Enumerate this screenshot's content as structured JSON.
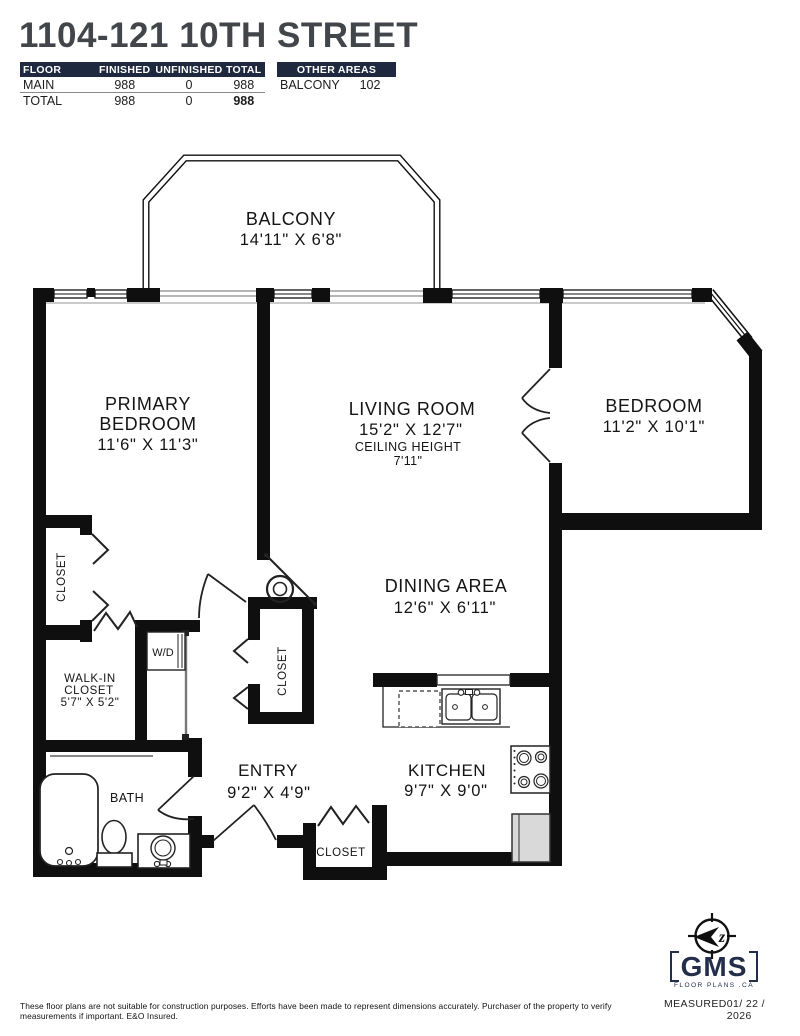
{
  "header": {
    "title": "1104-121 10TH STREET",
    "floor_table": {
      "headers": [
        "FLOOR",
        "FINISHED",
        "UNFINISHED",
        "TOTAL"
      ],
      "rows": [
        {
          "floor": "MAIN",
          "finished": "988",
          "unfinished": "0",
          "total": "988"
        },
        {
          "floor": "TOTAL",
          "finished": "988",
          "unfinished": "0",
          "total": "988"
        }
      ]
    },
    "other_areas_table": {
      "header": "OTHER AREAS",
      "rows": [
        {
          "area": "BALCONY",
          "value": "102"
        }
      ]
    }
  },
  "plan": {
    "balcony": {
      "name": "BALCONY",
      "dims": "14'11\" X 6'8\""
    },
    "primary_bedroom": {
      "line1": "PRIMARY",
      "line2": "BEDROOM",
      "dims": "11'6\" X 11'3\""
    },
    "living_room": {
      "name": "LIVING ROOM",
      "dims": "15'2\" X 12'7\"",
      "ceiling_label": "CEILING HEIGHT",
      "ceiling_value": "7'11\""
    },
    "bedroom": {
      "name": "BEDROOM",
      "dims": "11'2\" X 10'1\""
    },
    "dining_area": {
      "name": "DINING AREA",
      "dims": "12'6\" X 6'11\""
    },
    "kitchen": {
      "name": "KITCHEN",
      "dims": "9'7\" X 9'0\""
    },
    "entry": {
      "name": "ENTRY",
      "dims": "9'2\" X 4'9\""
    },
    "bath": {
      "name": "BATH"
    },
    "walk_in_closet": {
      "line1": "WALK-IN",
      "line2": "CLOSET",
      "dims": "5'7\" X 5'2\""
    },
    "closet_left": {
      "name": "CLOSET"
    },
    "closet_center": {
      "name": "CLOSET"
    },
    "closet_entry": {
      "name": "CLOSET"
    },
    "wd": {
      "name": "W/D"
    },
    "compass": {
      "letter": "z"
    }
  },
  "footer": {
    "disclaimer": "These floor plans are not suitable for construction purposes. Efforts have been made to represent dimensions accurately.  Purchaser of the property to verify measurements if important.  E&O Insured.",
    "measured_label": "MEASURED",
    "measured_date": "01/ 22 / 2026",
    "logo_text": "GMS",
    "logo_sub": "FLOOR PLANS .CA"
  },
  "colors": {
    "navy": "#1e2940",
    "title_gray": "#42464b",
    "wall_black": "#0f0f0f"
  }
}
